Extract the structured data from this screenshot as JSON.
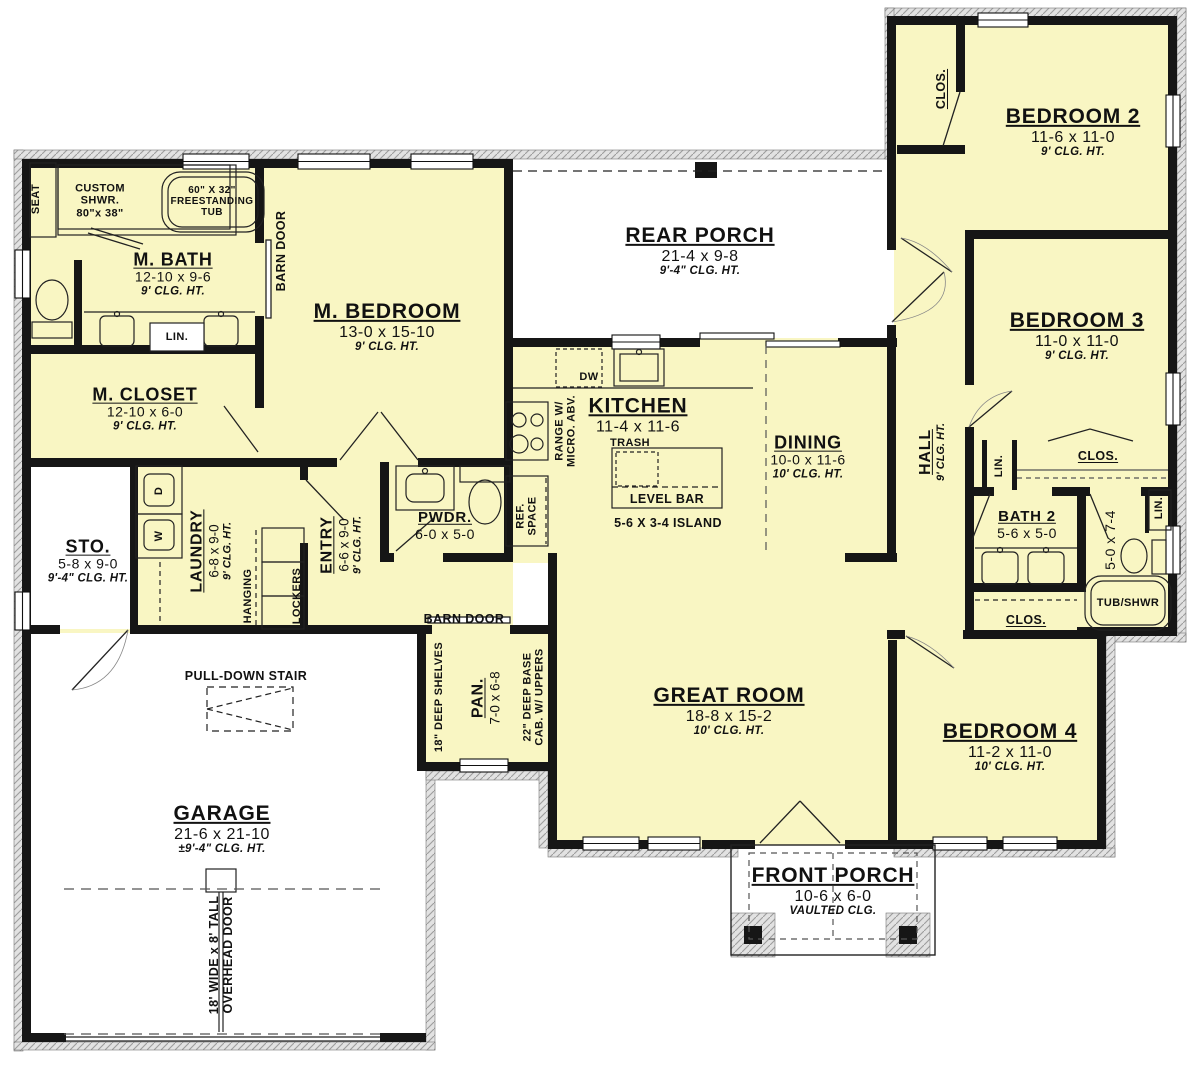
{
  "palette": {
    "floor_yellow": "#f9f6c3",
    "wall_black": "#161616",
    "hatch_gray": "#9d9d9d",
    "background": "#ffffff"
  },
  "rooms": {
    "m_bath": {
      "name": "M. BATH",
      "dims": "12-10 x 9-6",
      "clg": "9' CLG. HT."
    },
    "m_closet": {
      "name": "M. CLOSET",
      "dims": "12-10 x 6-0",
      "clg": "9' CLG. HT."
    },
    "m_bedroom": {
      "name": "M. BEDROOM",
      "dims": "13-0 x 15-10",
      "clg": "9' CLG. HT."
    },
    "rear_porch": {
      "name": "REAR PORCH",
      "dims": "21-4 x 9-8",
      "clg": "9'-4\" CLG. HT."
    },
    "kitchen": {
      "name": "KITCHEN",
      "dims": "11-4 x 11-6"
    },
    "dining": {
      "name": "DINING",
      "dims": "10-0 x 11-6",
      "clg": "10' CLG. HT."
    },
    "great_room": {
      "name": "GREAT ROOM",
      "dims": "18-8 x 15-2",
      "clg": "10' CLG. HT."
    },
    "sto": {
      "name": "STO.",
      "dims": "5-8 x 9-0",
      "clg": "9'-4\" CLG. HT."
    },
    "laundry": {
      "name": "LAUNDRY",
      "dims": "6-8 x 9-0",
      "clg": "9' CLG. HT."
    },
    "entry": {
      "name": "ENTRY",
      "dims": "6-6 x 9-0",
      "clg": "9' CLG. HT."
    },
    "pwdr": {
      "name": "PWDR.",
      "dims": "6-0 x 5-0"
    },
    "pan": {
      "name": "PAN.",
      "dims": "7-0 x 6-8"
    },
    "garage": {
      "name": "GARAGE",
      "dims": "21-6 x 21-10",
      "clg": "±9'-4\" CLG. HT."
    },
    "front_porch": {
      "name": "FRONT PORCH",
      "dims": "10-6 x 6-0",
      "clg": "VAULTED CLG."
    },
    "bedroom2": {
      "name": "BEDROOM 2",
      "dims": "11-6 x 11-0",
      "clg": "9' CLG. HT."
    },
    "bedroom3": {
      "name": "BEDROOM 3",
      "dims": "11-0 x 11-0",
      "clg": "9' CLG. HT."
    },
    "bedroom4": {
      "name": "BEDROOM 4",
      "dims": "11-2 x 11-0",
      "clg": "10' CLG. HT."
    },
    "bath2": {
      "name": "BATH 2",
      "dims": "5-6 x 5-0"
    },
    "hall": {
      "name": "HALL",
      "clg": "9' CLG. HT."
    },
    "tub_room": {
      "dims": "5-0 x 7-4"
    }
  },
  "labels": {
    "seat": "SEAT",
    "custom_shwr_line1": "CUSTOM",
    "custom_shwr_line2": "SHWR.",
    "custom_shwr_line3": "80\"x 38\"",
    "tub_line1": "60\" X 32\"",
    "tub_line2": "FREESTANDING",
    "tub_line3": "TUB",
    "barn_door": "BARN DOOR",
    "lin": "LIN.",
    "clos": "CLOS.",
    "dw": "DW",
    "d": "D",
    "w": "W",
    "range_line1": "RANGE W/",
    "range_line2": "MICRO. ABV.",
    "ref_line1": "REF.",
    "ref_line2": "SPACE",
    "trash": "TRASH",
    "level_bar": "LEVEL BAR",
    "island": "5-6 X 3-4 ISLAND",
    "hanging": "HANGING",
    "lockers": "LOCKERS",
    "pull_down_stair": "PULL-DOWN STAIR",
    "overhead_line1": "18' WIDE x 8' TALL",
    "overhead_line2": "OVERHEAD DOOR",
    "shelves": "18\" DEEP SHELVES",
    "base_cab_line1": "22\" DEEP BASE",
    "base_cab_line2": "CAB. W/ UPPERS",
    "tub_shwr": "TUB/SHWR"
  }
}
